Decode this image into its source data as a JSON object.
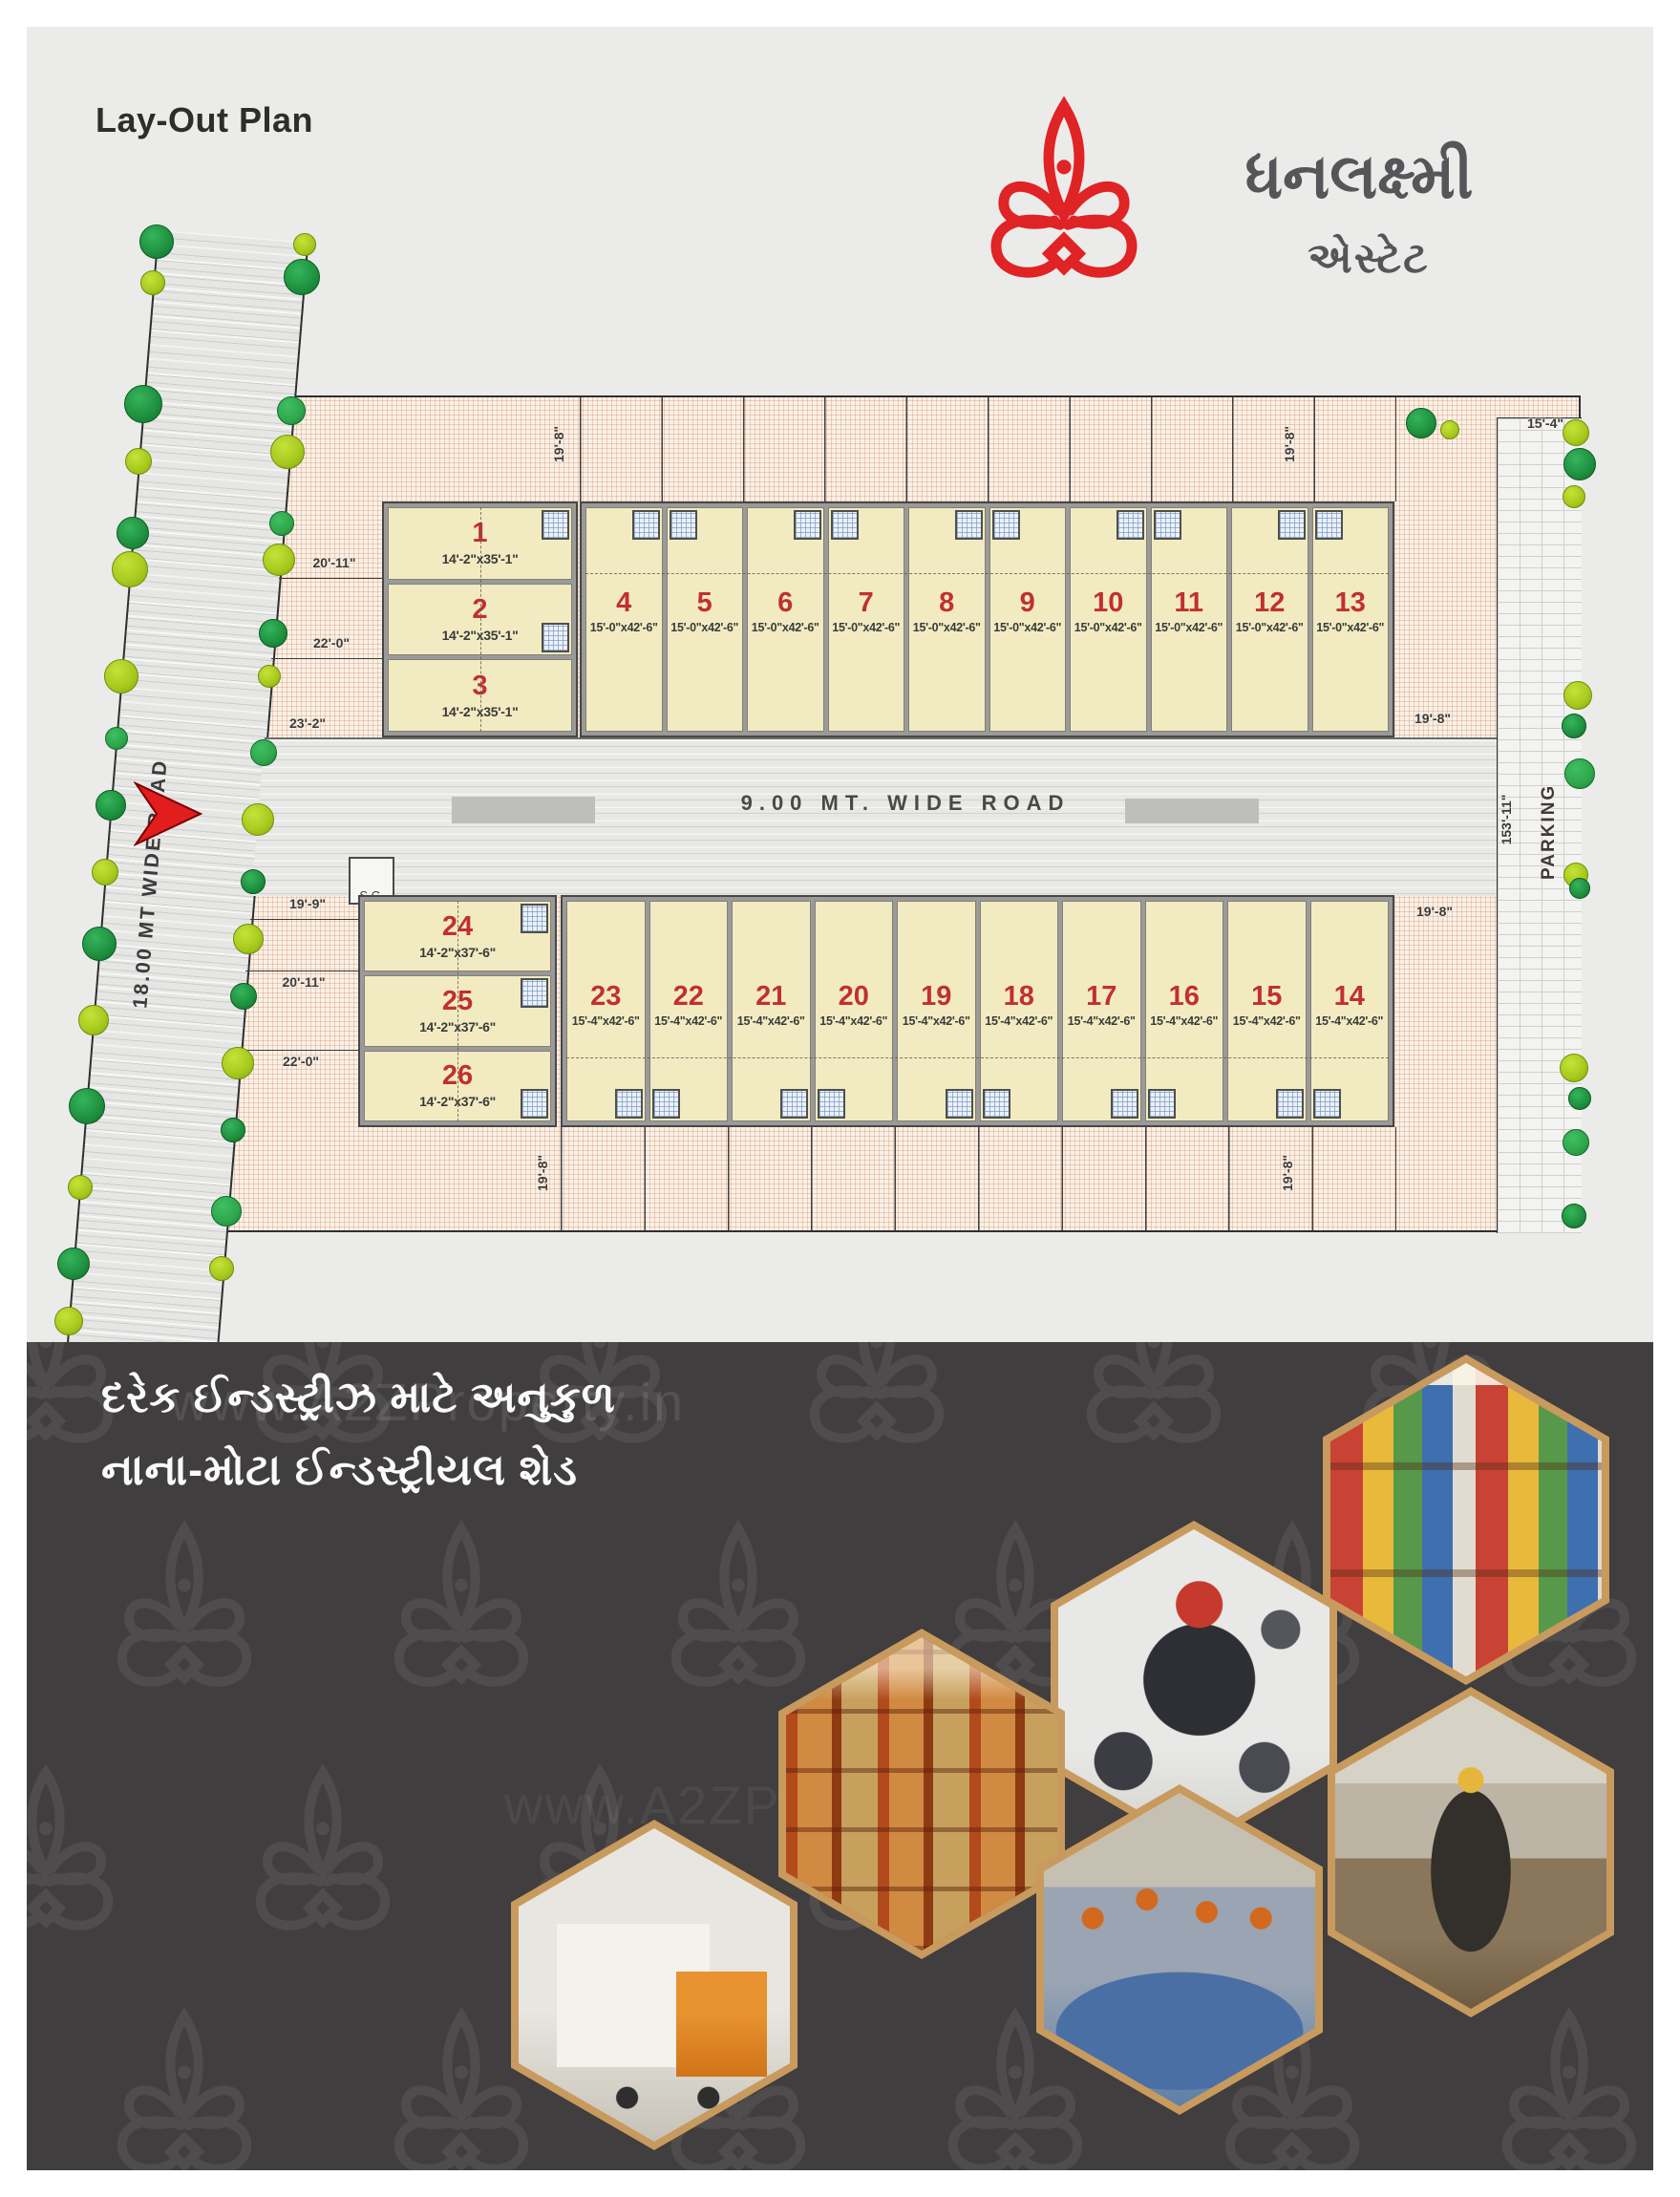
{
  "header": {
    "title": "Lay-Out Plan",
    "logo": "lotus-icon",
    "brand_name": "ધનલક્ષ્મી",
    "brand_subtitle": "એસ્ટેટ"
  },
  "plan": {
    "roads": {
      "west_road": "18.00 MT WIDE ROAD",
      "central_road": "9.00 MT. WIDE ROAD",
      "sc_label": "S.C.",
      "parking_label": "PARKING"
    },
    "dims": {
      "d19_8": "19'-8\"",
      "d20_11": "20'-11\"",
      "d22_0": "22'-0\"",
      "d23_2": "23'-2\"",
      "d19_9": "19'-9\"",
      "d15_4": "15'-4\"",
      "d153_11": "153'-11\""
    },
    "plots": {
      "top_left": [
        {
          "no": "1",
          "size": "14'-2\"x35'-1\""
        },
        {
          "no": "2",
          "size": "14'-2\"x35'-1\""
        },
        {
          "no": "3",
          "size": "14'-2\"x35'-1\""
        }
      ],
      "top_row": [
        {
          "no": "4",
          "size": "15'-0\"x42'-6\""
        },
        {
          "no": "5",
          "size": "15'-0\"x42'-6\""
        },
        {
          "no": "6",
          "size": "15'-0\"x42'-6\""
        },
        {
          "no": "7",
          "size": "15'-0\"x42'-6\""
        },
        {
          "no": "8",
          "size": "15'-0\"x42'-6\""
        },
        {
          "no": "9",
          "size": "15'-0\"x42'-6\""
        },
        {
          "no": "10",
          "size": "15'-0\"x42'-6\""
        },
        {
          "no": "11",
          "size": "15'-0\"x42'-6\""
        },
        {
          "no": "12",
          "size": "15'-0\"x42'-6\""
        },
        {
          "no": "13",
          "size": "15'-0\"x42'-6\""
        }
      ],
      "bottom_left": [
        {
          "no": "24",
          "size": "14'-2\"x37'-6\""
        },
        {
          "no": "25",
          "size": "14'-2\"x37'-6\""
        },
        {
          "no": "26",
          "size": "14'-2\"x37'-6\""
        }
      ],
      "bottom_row": [
        {
          "no": "23",
          "size": "15'-4\"x42'-6\""
        },
        {
          "no": "22",
          "size": "15'-4\"x42'-6\""
        },
        {
          "no": "21",
          "size": "15'-4\"x42'-6\""
        },
        {
          "no": "20",
          "size": "15'-4\"x42'-6\""
        },
        {
          "no": "19",
          "size": "15'-4\"x42'-6\""
        },
        {
          "no": "18",
          "size": "15'-4\"x42'-6\""
        },
        {
          "no": "17",
          "size": "15'-4\"x42'-6\""
        },
        {
          "no": "16",
          "size": "15'-4\"x42'-6\""
        },
        {
          "no": "15",
          "size": "15'-4\"x42'-6\""
        },
        {
          "no": "14",
          "size": "15'-4\"x42'-6\""
        }
      ]
    }
  },
  "footer": {
    "tagline_line1": "દરેક ઈન્ડસ્ટ્રીઝ માટે અનુકુળ",
    "tagline_line2": "નાના-મોટા ઈન્ડસ્ટ્રીયલ શેડ",
    "watermark": "www.A2ZProperty.in",
    "hexagon_photos": [
      "grocery-products",
      "pvc-valves-fittings",
      "warehouse-racks",
      "factory-worker",
      "textile-workers",
      "cargo-truck"
    ]
  },
  "colors": {
    "brand_red": "#E02325",
    "plot_number_red": "#C13030",
    "plot_fill": "#F2EBC1",
    "gold_border": "#C89A5E",
    "dark_bg": "#403E3E"
  }
}
